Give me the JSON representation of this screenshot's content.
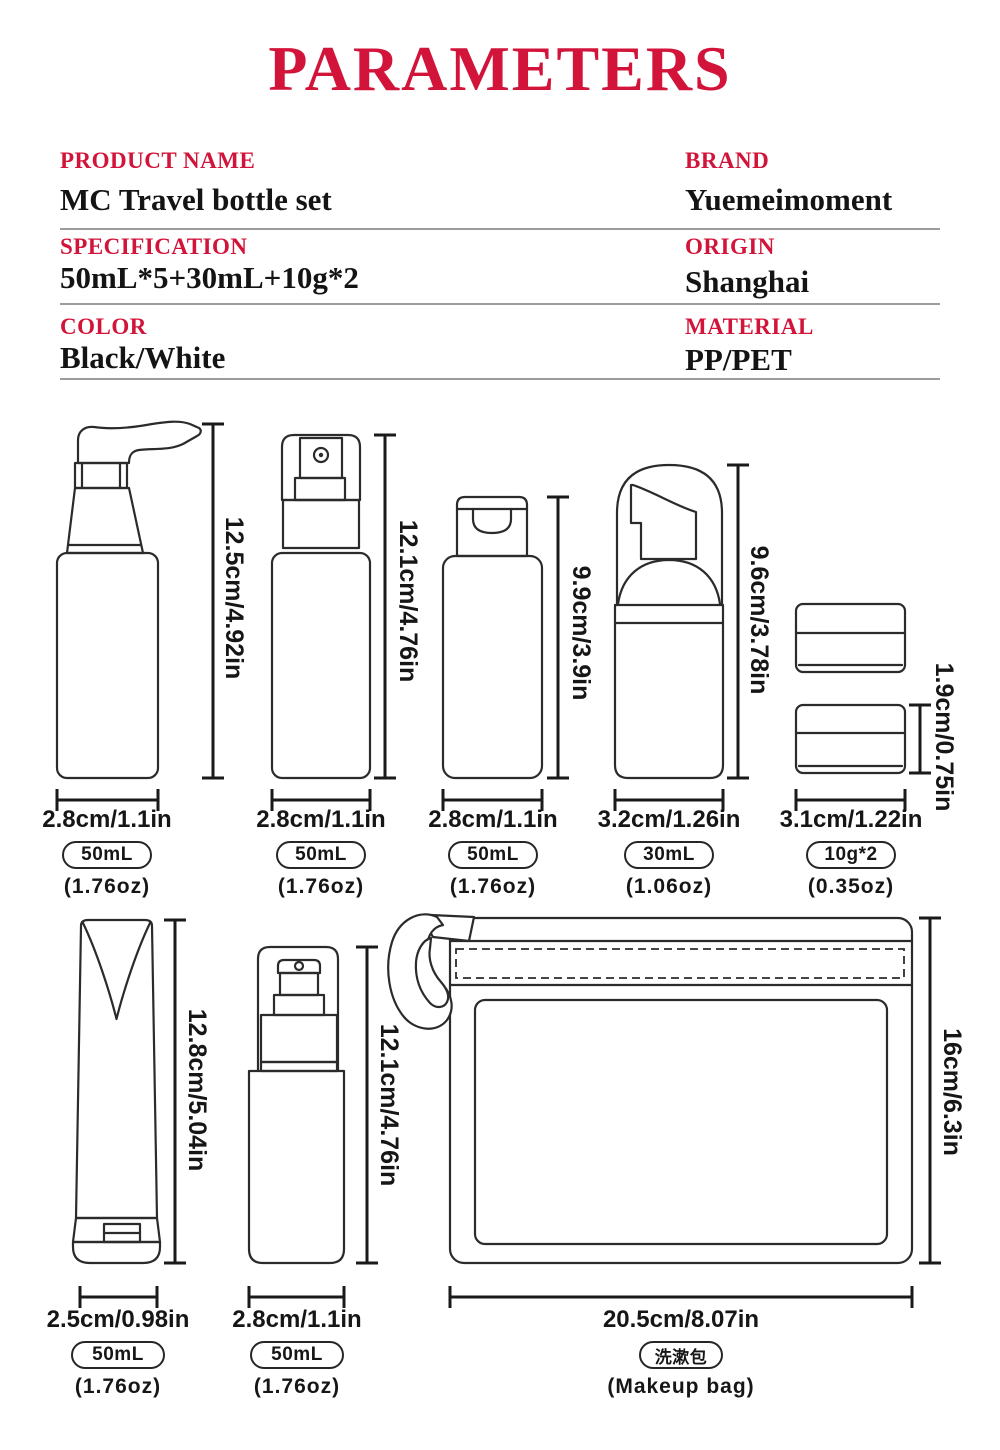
{
  "title": "PARAMETERS",
  "accent_color": "#d2143a",
  "spec_table": {
    "rows": [
      {
        "label": "PRODUCT NAME",
        "value": "MC Travel bottle set"
      },
      {
        "label": "BRAND",
        "value": "Yuemeimoment"
      },
      {
        "label": "SPECIFICATION",
        "value": "50mL*5+30mL+10g*2"
      },
      {
        "label": "ORIGIN",
        "value": "Shanghai"
      },
      {
        "label": "COLOR",
        "value": "Black/White"
      },
      {
        "label": "MATERIAL",
        "value": "PP/PET"
      }
    ]
  },
  "items": [
    {
      "height_label": "12.5cm/4.92in",
      "width_label": "2.8cm/1.1in",
      "capacity": "50mL",
      "capacity_alt": "(1.76oz)"
    },
    {
      "height_label": "12.1cm/4.76in",
      "width_label": "2.8cm/1.1in",
      "capacity": "50mL",
      "capacity_alt": "(1.76oz)"
    },
    {
      "height_label": "9.9cm/3.9in",
      "width_label": "2.8cm/1.1in",
      "capacity": "50mL",
      "capacity_alt": "(1.76oz)"
    },
    {
      "height_label": "9.6cm/3.78in",
      "width_label": "3.2cm/1.26in",
      "capacity": "30mL",
      "capacity_alt": "(1.06oz)"
    },
    {
      "height_label": "1.9cm/0.75in",
      "width_label": "3.1cm/1.22in",
      "capacity": "10g*2",
      "capacity_alt": "(0.35oz)"
    },
    {
      "height_label": "12.8cm/5.04in",
      "width_label": "2.5cm/0.98in",
      "capacity": "50mL",
      "capacity_alt": "(1.76oz)"
    },
    {
      "height_label": "12.1cm/4.76in",
      "width_label": "2.8cm/1.1in",
      "capacity": "50mL",
      "capacity_alt": "(1.76oz)"
    },
    {
      "height_label": "16cm/6.3in",
      "width_label": "20.5cm/8.07in",
      "capacity": "洗漱包",
      "capacity_alt": "(Makeup bag)"
    }
  ]
}
